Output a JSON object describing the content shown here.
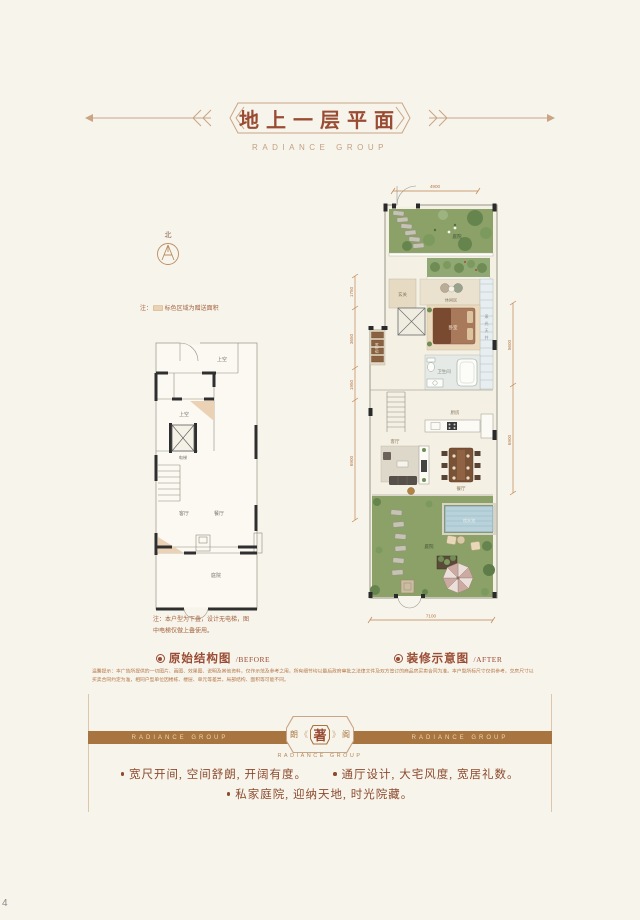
{
  "page_number": "4",
  "header": {
    "title": "地上一层平面",
    "subtitle": "RADIANCE GROUP"
  },
  "compass": {
    "north_label": "北"
  },
  "legend_note": {
    "prefix": "注：",
    "text": "标色区域为赠送面积"
  },
  "before_plan": {
    "caption": "原始结构图",
    "caption_en": "/BEFORE",
    "note_line1": "注：本户型为下叠，设计无电梯，图",
    "note_line2": "中电梯仅做上叠使用。",
    "rooms": {
      "void_top": "上空",
      "void_mid": "上空",
      "elevator": "电梯",
      "living": "客厅",
      "dining": "餐厅",
      "courtyard": "庭院"
    }
  },
  "after_plan": {
    "caption": "装修示意图",
    "caption_en": "/AFTER",
    "dims": {
      "top": "4900",
      "bottom": "7100",
      "left1": "1750",
      "left2": "3650",
      "left3": "1950",
      "left4": "6900",
      "right1": "5600",
      "right2": "6900"
    },
    "rooms": {
      "garden_top": "庭院",
      "lounge": "休闲区",
      "entry": "玄关",
      "bedroom": "卧室",
      "wardrobe": "衣帽间",
      "bath": "卫生间",
      "kitchen": "厨房",
      "living": "客厅",
      "dining": "餐厅",
      "pool": "戏水池",
      "garden_bottom": "庭院",
      "lightwell_chars": [
        "采",
        "光",
        "天",
        "井"
      ]
    }
  },
  "disclaimer": {
    "line1": "温馨提示：本广告所提供的一切图片、画图、效果图、说明及其他资料，仅作示范及参考之用，所有细节均以最后政府审批之法律文件及双方签订的商品房买卖合同为准。本户型所标尺寸仅供参考，交房尺寸以",
    "line2": "买卖合同约定为准，相同户型单位因楼栋、楼层、单元等差异，局部结构、面积等可能不同。"
  },
  "banner": {
    "left_text": "RADIANCE GROUP",
    "right_text": "RADIANCE GROUP",
    "emblem": {
      "left_char": "朗",
      "deco_left": "《",
      "center_char": "著",
      "deco_right": "》",
      "right_char": "阁"
    },
    "sub_text": "RADIANCE GROUP"
  },
  "bullets": [
    "宽尺开间, 空间舒朗, 开阔有度。",
    "通厅设计, 大宅风度, 宽居礼数。",
    "私家庭院, 迎纳天地, 时光院藏。"
  ],
  "colors": {
    "accent": "#9a4b33",
    "tan_line": "#c9a585",
    "banner_brown": "#a8743f",
    "gift_area": "#ecd2b5"
  }
}
